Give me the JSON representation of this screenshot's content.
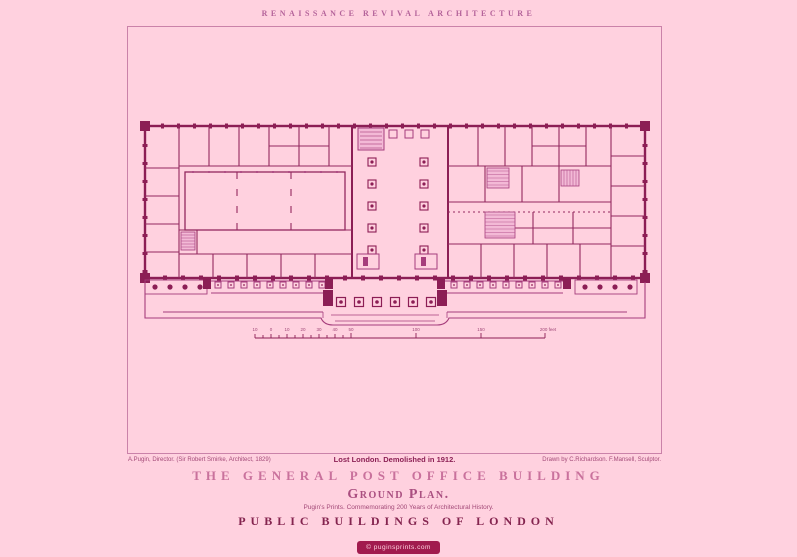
{
  "header": {
    "series_header": "RENAISSANCE REVIVAL ARCHITECTURE"
  },
  "captions": {
    "credit_left": "A.Pugin, Director. (Sir Robert Smirke, Architect, 1829)",
    "status_center": "Lost London. Demolished in 1912.",
    "credit_right": "Drawn by C.Richardson. F.Mansell, Sculptor."
  },
  "titles": {
    "building": "THE GENERAL POST OFFICE BUILDING",
    "plan_type": "Ground Plan.",
    "tagline": "Pugin's Prints. Commemorating 200 Years of Architectural History.",
    "series": "PUBLIC BUILDINGS OF LONDON"
  },
  "badge": {
    "text": "© puginsprints.com"
  },
  "plan": {
    "subject": "ground-plan-of-general-post-office",
    "scale": {
      "labels": [
        "10",
        "0",
        "10",
        "20",
        "30",
        "40",
        "50",
        "100",
        "150",
        "200 feet"
      ]
    }
  },
  "colors": {
    "background": "#ffd1df",
    "ink_dark": "#8c1e55",
    "ink_medium": "#a63d7c",
    "ink_light": "#c46fa2",
    "frame_border": "#ca82a9",
    "title_rose": "#c9719c",
    "title_maroon": "#84244f",
    "header_mauve": "#b4639a",
    "badge_background": "#a11b4e",
    "badge_text": "#ffd1df"
  }
}
